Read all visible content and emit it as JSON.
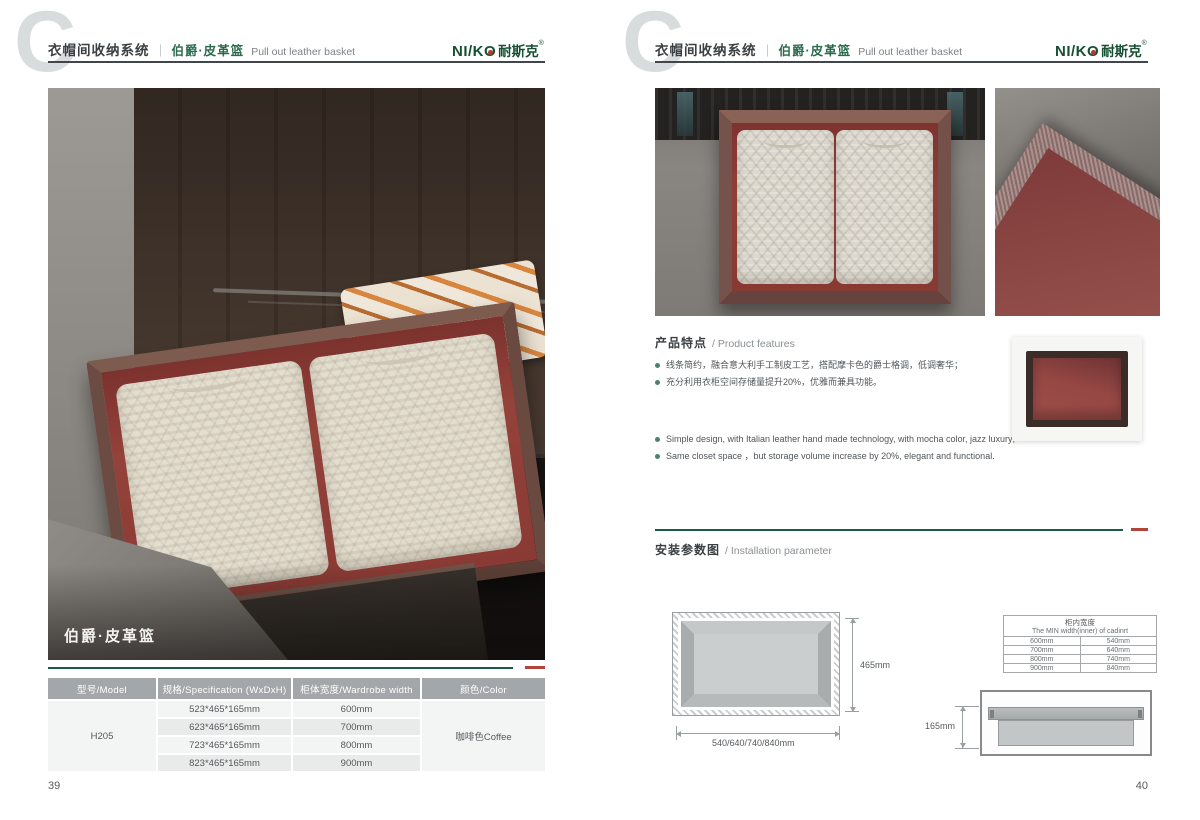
{
  "header": {
    "watermark": "C",
    "category": "衣帽间收纳系统",
    "separator": "｜",
    "product_cn": "伯爵·皮革篮",
    "product_en": "Pull out leather basket"
  },
  "brand": {
    "latin": "NI/KO",
    "cn": "耐斯克",
    "reg": "®"
  },
  "accent": {
    "green": "#1d5c44",
    "red": "#b2453a",
    "header_green": "#2c6a4d"
  },
  "page_left": {
    "photo_caption": "伯爵·皮革篮",
    "page_number": "39",
    "table": {
      "headers": [
        "型号/Model",
        "规格/Specification (WxDxH)",
        "柜体宽度/Wardrobe width",
        "颜色/Color"
      ],
      "model": "H205",
      "color": "咖啡色Coffee",
      "rows": [
        {
          "spec": "523*465*165mm",
          "width": "600mm"
        },
        {
          "spec": "623*465*165mm",
          "width": "700mm"
        },
        {
          "spec": "723*465*165mm",
          "width": "800mm"
        },
        {
          "spec": "823*465*165mm",
          "width": "900mm"
        }
      ]
    }
  },
  "page_right": {
    "page_number": "40",
    "features": {
      "title_cn": "产品特点",
      "title_en": "/ Product features",
      "bullets_cn": [
        "线条简约，融合意大利手工制皮工艺，搭配摩卡色的爵士格调，低调奢华；",
        "充分利用衣柜空间存储量提升20%，优雅而兼具功能。"
      ],
      "bullets_en": [
        "Simple design, with Italian leather hand made technology, with mocha color, jazz  luxury;",
        "Same closet space ，but storage volume increase by 20%, elegant and functional."
      ]
    },
    "installation": {
      "title_cn": "安装参数图",
      "title_en": "/ Installation parameter",
      "top_view": {
        "depth_label": "465mm",
        "width_label": "540/640/740/840mm"
      },
      "side_view": {
        "height_label": "165mm"
      },
      "min_width_table": {
        "title_cn": "柜内宽度",
        "title_en": "The MIN width(inner) of cadinrt",
        "rows": [
          [
            "600mm",
            "540mm"
          ],
          [
            "700mm",
            "640mm"
          ],
          [
            "800mm",
            "740mm"
          ],
          [
            "900mm",
            "840mm"
          ]
        ]
      }
    }
  }
}
